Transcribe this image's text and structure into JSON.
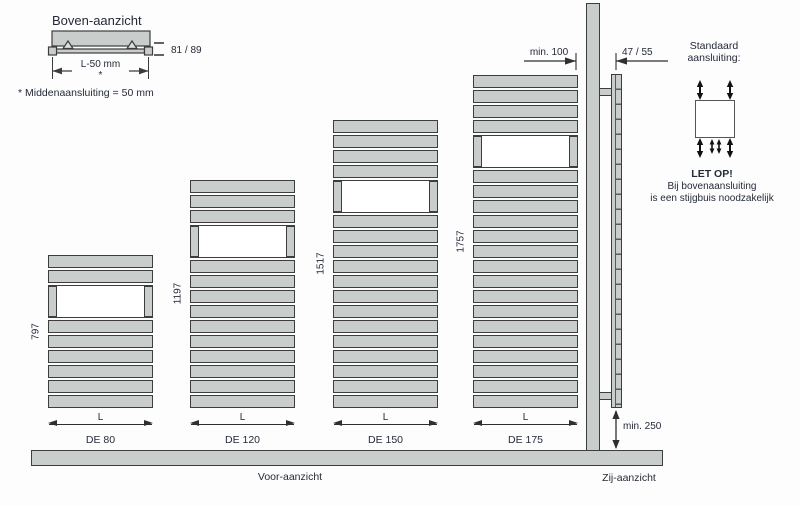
{
  "top_view": {
    "title": "Boven-aanzicht",
    "width_dim_label": "L-50 mm",
    "width_dim_star": "*",
    "depth_dim_label": "81 / 89",
    "note": "* Middenaansluiting = 50 mm"
  },
  "front_view": {
    "label": "Voor-aanzicht",
    "width_dim_label": "L",
    "radiators": [
      {
        "model": "DE 80",
        "height_mm": "797",
        "slats_above_gap": 2,
        "slats_below_gap": 6
      },
      {
        "model": "DE 120",
        "height_mm": "1197",
        "slats_above_gap": 3,
        "slats_below_gap": 10
      },
      {
        "model": "DE 150",
        "height_mm": "1517",
        "slats_above_gap": 4,
        "slats_below_gap": 13
      },
      {
        "model": "DE 175",
        "height_mm": "1757",
        "slats_above_gap": 4,
        "slats_below_gap": 16
      }
    ]
  },
  "side_view": {
    "label": "Zij-aanzicht",
    "wall_clearance_label": "min. 100",
    "depth_label": "47 / 55",
    "floor_clearance_label": "min. 250"
  },
  "connection": {
    "title_line1": "Standaard",
    "title_line2": "aansluiting:",
    "warning_title": "LET OP!",
    "warning_line1": "Bij bovenaansluiting",
    "warning_line2": "is een stijgbuis noodzakelijk"
  },
  "colors": {
    "radiator_fill": "#c9cdcc",
    "outline": "#3d3d3d",
    "text": "#252a38"
  }
}
